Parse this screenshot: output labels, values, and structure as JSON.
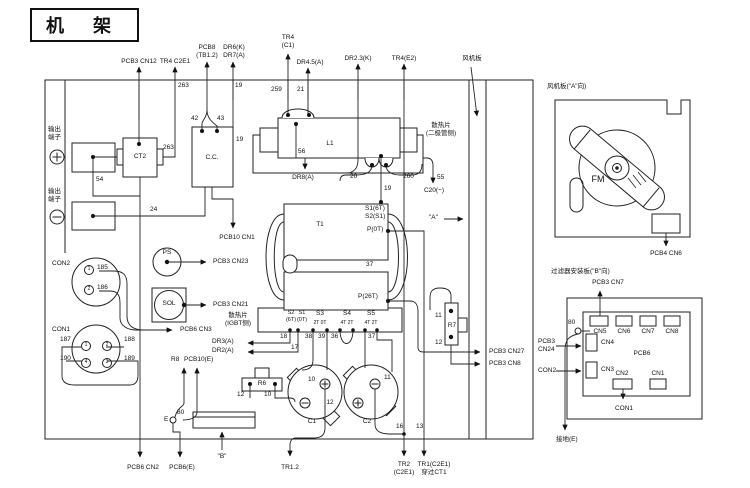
{
  "title": "机  架",
  "accent_colors": {
    "line": "#222222",
    "background": "#ffffff",
    "text": "#111111"
  },
  "icons": {
    "plus-terminal": "circle-plus",
    "minus-terminal": "circle-minus",
    "arrowhead": "filled-triangle",
    "junction": "filled-dot",
    "fan": "blade-rotor"
  },
  "labels": [
    {
      "name": "pcb3-cn12-label",
      "text": "PCB3 CN12",
      "x": 139,
      "y": 58,
      "ctr": 1
    },
    {
      "name": "tr4-c2e1-label",
      "text": "TR4 C2E1",
      "x": 175,
      "y": 58,
      "ctr": 1
    },
    {
      "name": "pcb8-tb1-2-label",
      "text": "PCB8\n(TB1.2)",
      "x": 207,
      "y": 44,
      "ctr": 1
    },
    {
      "name": "dr6-dr7-label",
      "text": "DR6(K)\nDR7(A)",
      "x": 234,
      "y": 44,
      "ctr": 1
    },
    {
      "name": "tr4-c1-label",
      "text": "TR4\n(C1)",
      "x": 288,
      "y": 34,
      "ctr": 1
    },
    {
      "name": "dr4-5-label",
      "text": "DR4.5(A)",
      "x": 310,
      "y": 59,
      "ctr": 1
    },
    {
      "name": "dr2-3-label",
      "text": "DR2.3(K)",
      "x": 358,
      "y": 55,
      "ctr": 1
    },
    {
      "name": "tr4-e2-label",
      "text": "TR4(E2)",
      "x": 404,
      "y": 55,
      "ctr": 1
    },
    {
      "name": "fan-board-callout",
      "text": "风机板",
      "x": 472,
      "y": 55,
      "ctr": 1
    },
    {
      "name": "wire-263-top",
      "text": "263",
      "x": 178,
      "y": 82
    },
    {
      "name": "wire-19-top",
      "text": "19",
      "x": 235,
      "y": 82
    },
    {
      "name": "wire-259",
      "text": "259",
      "x": 271,
      "y": 86
    },
    {
      "name": "wire-21",
      "text": "21",
      "x": 297,
      "y": 86
    },
    {
      "name": "output-terminal-plus-label",
      "text": "输出\n端子",
      "x": 48,
      "y": 126
    },
    {
      "name": "output-terminal-minus-label",
      "text": "输出\n端子",
      "x": 48,
      "y": 188
    },
    {
      "name": "ct2-label",
      "text": "CT2",
      "x": 140,
      "y": 153,
      "ctr": 1
    },
    {
      "name": "wire-263-ct2",
      "text": "263",
      "x": 163,
      "y": 144
    },
    {
      "name": "wire-54",
      "text": "54",
      "x": 96,
      "y": 176
    },
    {
      "name": "wire-24",
      "text": "24",
      "x": 150,
      "y": 206
    },
    {
      "name": "cc-label",
      "text": "C.C.",
      "x": 212,
      "y": 154,
      "ctr": 1
    },
    {
      "name": "wire-42",
      "text": "42",
      "x": 191,
      "y": 115
    },
    {
      "name": "wire-43",
      "text": "43",
      "x": 217,
      "y": 115
    },
    {
      "name": "wire-19-cc",
      "text": "19",
      "x": 236,
      "y": 136
    },
    {
      "name": "pcb10-cn1-label",
      "text": "PCB10 CN1",
      "x": 237,
      "y": 234,
      "ctr": 1
    },
    {
      "name": "l1-label",
      "text": "L1",
      "x": 330,
      "y": 140,
      "ctr": 1
    },
    {
      "name": "wire-56",
      "text": "56",
      "x": 298,
      "y": 148
    },
    {
      "name": "heatsink-diode-label",
      "text": "散热片\n(二极管侧)",
      "x": 441,
      "y": 122,
      "ctr": 1
    },
    {
      "name": "dr8-label",
      "text": "DR8(A)",
      "x": 303,
      "y": 174,
      "ctr": 1
    },
    {
      "name": "wire-20",
      "text": "20",
      "x": 350,
      "y": 173
    },
    {
      "name": "wire-260",
      "text": "260",
      "x": 403,
      "y": 173
    },
    {
      "name": "wire-55",
      "text": "55",
      "x": 437,
      "y": 174
    },
    {
      "name": "c20-label",
      "text": "C20(−)",
      "x": 434,
      "y": 187,
      "ctr": 1
    },
    {
      "name": "wire-19-t1",
      "text": "19",
      "x": 384,
      "y": 185
    },
    {
      "name": "t1-label",
      "text": "T1",
      "x": 320,
      "y": 221,
      "ctr": 1
    },
    {
      "name": "t1-s1-6t",
      "text": "S1(6T)",
      "x": 365,
      "y": 205
    },
    {
      "name": "t1-s2-s1",
      "text": "S2(S1)",
      "x": 365,
      "y": 213
    },
    {
      "name": "t1-p-0t",
      "text": "P(0T)",
      "x": 367,
      "y": 226
    },
    {
      "name": "wire-37-mid",
      "text": "37",
      "x": 366,
      "y": 261
    },
    {
      "name": "t1-p-26t",
      "text": "P(26T)",
      "x": 358,
      "y": 293
    },
    {
      "name": "t1-s2-col",
      "text": "S2\n(6T)",
      "x": 291,
      "y": 310,
      "ctr": 1,
      "fs": 5.5
    },
    {
      "name": "t1-s1-col",
      "text": "S1\n(0T)",
      "x": 302,
      "y": 310,
      "ctr": 1,
      "fs": 5.5
    },
    {
      "name": "t1-s3-col",
      "text": "S3",
      "x": 320,
      "y": 310,
      "ctr": 1
    },
    {
      "name": "t1-s3-sub",
      "text": "2T 0T",
      "x": 320,
      "y": 320,
      "ctr": 1,
      "fs": 5
    },
    {
      "name": "t1-s4-col",
      "text": "S4",
      "x": 347,
      "y": 310,
      "ctr": 1
    },
    {
      "name": "t1-s4-sub",
      "text": "4T 2T",
      "x": 347,
      "y": 320,
      "ctr": 1,
      "fs": 5
    },
    {
      "name": "t1-s5-col",
      "text": "S5",
      "x": 371,
      "y": 310,
      "ctr": 1
    },
    {
      "name": "t1-s5-sub",
      "text": "4T 2T",
      "x": 371,
      "y": 320,
      "ctr": 1,
      "fs": 5
    },
    {
      "name": "wire-18",
      "text": "18",
      "x": 280,
      "y": 333
    },
    {
      "name": "wire-17",
      "text": "17",
      "x": 291,
      "y": 344
    },
    {
      "name": "wire-38",
      "text": "38",
      "x": 305,
      "y": 333
    },
    {
      "name": "wire-39",
      "text": "39",
      "x": 318,
      "y": 333
    },
    {
      "name": "wire-36",
      "text": "36",
      "x": 331,
      "y": 333
    },
    {
      "name": "wire-37-b",
      "text": "37",
      "x": 368,
      "y": 333
    },
    {
      "name": "heatsink-igbt-label",
      "text": "散热片\n(IGBT侧)",
      "x": 238,
      "y": 312,
      "ctr": 1
    },
    {
      "name": "dr3-label",
      "text": "DR3(A)",
      "x": 212,
      "y": 338
    },
    {
      "name": "dr2-label",
      "text": "DR2(A)",
      "x": 212,
      "y": 347
    },
    {
      "name": "con2-label",
      "text": "CON2",
      "x": 52,
      "y": 260
    },
    {
      "name": "con2-pin-1",
      "cls": "pin",
      "text": "1",
      "x": 84,
      "y": 265
    },
    {
      "name": "wire-185",
      "text": "185",
      "x": 97,
      "y": 264
    },
    {
      "name": "con2-pin-2",
      "cls": "pin",
      "text": "2",
      "x": 84,
      "y": 285
    },
    {
      "name": "wire-186",
      "text": "186",
      "x": 97,
      "y": 284
    },
    {
      "name": "ps-label",
      "text": "PS",
      "x": 167,
      "y": 249,
      "ctr": 1
    },
    {
      "name": "pcb3-cn23-label",
      "text": "PCB3 CN23",
      "x": 213,
      "y": 258
    },
    {
      "name": "sol-label",
      "text": "SOL",
      "x": 169,
      "y": 300,
      "ctr": 1
    },
    {
      "name": "pcb3-cn21-label",
      "text": "PCB3 CN21",
      "x": 213,
      "y": 301
    },
    {
      "name": "pcb6-cn3-label",
      "text": "PCB6 CN3",
      "x": 180,
      "y": 326
    },
    {
      "name": "con1-label",
      "text": "CON1",
      "x": 52,
      "y": 326
    },
    {
      "name": "wire-187",
      "text": "187",
      "x": 60,
      "y": 336
    },
    {
      "name": "con1-pin-1",
      "cls": "pin",
      "text": "1",
      "x": 81,
      "y": 341
    },
    {
      "name": "con1-pin-2",
      "cls": "pin",
      "text": "2",
      "x": 102,
      "y": 341
    },
    {
      "name": "wire-188",
      "text": "188",
      "x": 124,
      "y": 336
    },
    {
      "name": "wire-190",
      "text": "190",
      "x": 60,
      "y": 355
    },
    {
      "name": "con1-pin-4",
      "cls": "pin",
      "text": "4",
      "x": 81,
      "y": 358
    },
    {
      "name": "con1-pin-3",
      "cls": "pin",
      "text": "3",
      "x": 102,
      "y": 358
    },
    {
      "name": "wire-189",
      "text": "189",
      "x": 124,
      "y": 355
    },
    {
      "name": "r8-label",
      "text": "R8",
      "x": 171,
      "y": 356
    },
    {
      "name": "pcb10-e-label",
      "text": "PCB10(E)",
      "x": 184,
      "y": 356
    },
    {
      "name": "e-label",
      "text": "E",
      "x": 164,
      "y": 416
    },
    {
      "name": "wire-80",
      "text": "80",
      "x": 177,
      "y": 409
    },
    {
      "name": "b-direction-label",
      "text": "\"B\"",
      "x": 222,
      "y": 453,
      "ctr": 1
    },
    {
      "name": "pcb6-cn2-label",
      "text": "PCB6 CN2",
      "x": 143,
      "y": 464,
      "ctr": 1
    },
    {
      "name": "pcb6-e-label",
      "text": "PCB6(E)",
      "x": 182,
      "y": 464,
      "ctr": 1
    },
    {
      "name": "r6-label",
      "text": "R6",
      "x": 262,
      "y": 380,
      "ctr": 1
    },
    {
      "name": "wire-12-r6",
      "text": "12",
      "x": 237,
      "y": 391
    },
    {
      "name": "wire-10-r6",
      "text": "10",
      "x": 264,
      "y": 391
    },
    {
      "name": "wire-10-c1",
      "text": "10",
      "x": 308,
      "y": 376
    },
    {
      "name": "wire-11-c2",
      "text": "11",
      "x": 384,
      "y": 374
    },
    {
      "name": "wire-12-bus",
      "text": "12",
      "x": 330,
      "y": 399,
      "ctr": 1
    },
    {
      "name": "c1-label",
      "text": "C1",
      "x": 312,
      "y": 418,
      "ctr": 1
    },
    {
      "name": "c2-label",
      "text": "C2",
      "x": 367,
      "y": 418,
      "ctr": 1
    },
    {
      "name": "tr1-2-label",
      "text": "TR1.2",
      "x": 290,
      "y": 464,
      "ctr": 1
    },
    {
      "name": "wire-16",
      "text": "16",
      "x": 396,
      "y": 423
    },
    {
      "name": "wire-13",
      "text": "13",
      "x": 416,
      "y": 423
    },
    {
      "name": "tr2-label",
      "text": "TR2\n(C2E1)",
      "x": 404,
      "y": 461,
      "ctr": 1
    },
    {
      "name": "tr1-label",
      "text": "TR1(C2E1)\n穿过CT1",
      "x": 434,
      "y": 461,
      "ctr": 1
    },
    {
      "name": "r7-wire-11",
      "text": "11",
      "x": 435,
      "y": 312
    },
    {
      "name": "r7-label",
      "text": "R7",
      "x": 452,
      "y": 322,
      "ctr": 1
    },
    {
      "name": "r7-wire-12",
      "text": "12",
      "x": 435,
      "y": 339
    },
    {
      "name": "pcb3-cn27-label",
      "text": "PCB3 CN27",
      "x": 489,
      "y": 348
    },
    {
      "name": "pcb3-cn8-label",
      "text": "PCB3 CN8",
      "x": 489,
      "y": 360
    },
    {
      "name": "a-direction-label",
      "text": "\"A\"",
      "x": 429,
      "y": 214
    },
    {
      "name": "fan-panel-title",
      "text": "风机板(\"A\"向)",
      "x": 547,
      "y": 83
    },
    {
      "name": "fm-label",
      "text": "FM",
      "x": 598,
      "y": 174,
      "ctr": 1,
      "fs": 9
    },
    {
      "name": "pcb4-cn6-label",
      "text": "PCB4 CN6",
      "x": 666,
      "y": 250,
      "ctr": 1
    },
    {
      "name": "filter-panel-title",
      "text": "过滤器安装板(\"B\"向)",
      "x": 551,
      "y": 268
    },
    {
      "name": "pcb3-cn7-label",
      "text": "PCB3 CN7",
      "x": 608,
      "y": 279,
      "ctr": 1
    },
    {
      "name": "wire-80-filter",
      "text": "80",
      "x": 568,
      "y": 319
    },
    {
      "name": "pcb3-cn24-label",
      "text": "PCB3\nCN24",
      "x": 538,
      "y": 338
    },
    {
      "name": "con2-right-label",
      "text": "CON2",
      "x": 538,
      "y": 367
    },
    {
      "name": "pcb6-board-label",
      "text": "PCB6",
      "x": 642,
      "y": 350,
      "ctr": 1
    },
    {
      "name": "cn5-label",
      "text": "CN5",
      "x": 600,
      "y": 328,
      "ctr": 1
    },
    {
      "name": "cn6-label",
      "text": "CN6",
      "x": 624,
      "y": 328,
      "ctr": 1
    },
    {
      "name": "cn7-label",
      "text": "CN7",
      "x": 648,
      "y": 328,
      "ctr": 1
    },
    {
      "name": "cn8-label",
      "text": "CN8",
      "x": 672,
      "y": 328,
      "ctr": 1
    },
    {
      "name": "cn4-label",
      "text": "CN4",
      "x": 601,
      "y": 339
    },
    {
      "name": "cn3-label",
      "text": "CN3",
      "x": 601,
      "y": 366
    },
    {
      "name": "cn2-b-label",
      "text": "CN2",
      "x": 622,
      "y": 370,
      "ctr": 1
    },
    {
      "name": "cn1-b-label",
      "text": "CN1",
      "x": 658,
      "y": 370,
      "ctr": 1
    },
    {
      "name": "con1-right-label",
      "text": "CON1",
      "x": 624,
      "y": 405,
      "ctr": 1
    },
    {
      "name": "ground-label",
      "text": "接地(E)",
      "x": 556,
      "y": 436
    }
  ]
}
